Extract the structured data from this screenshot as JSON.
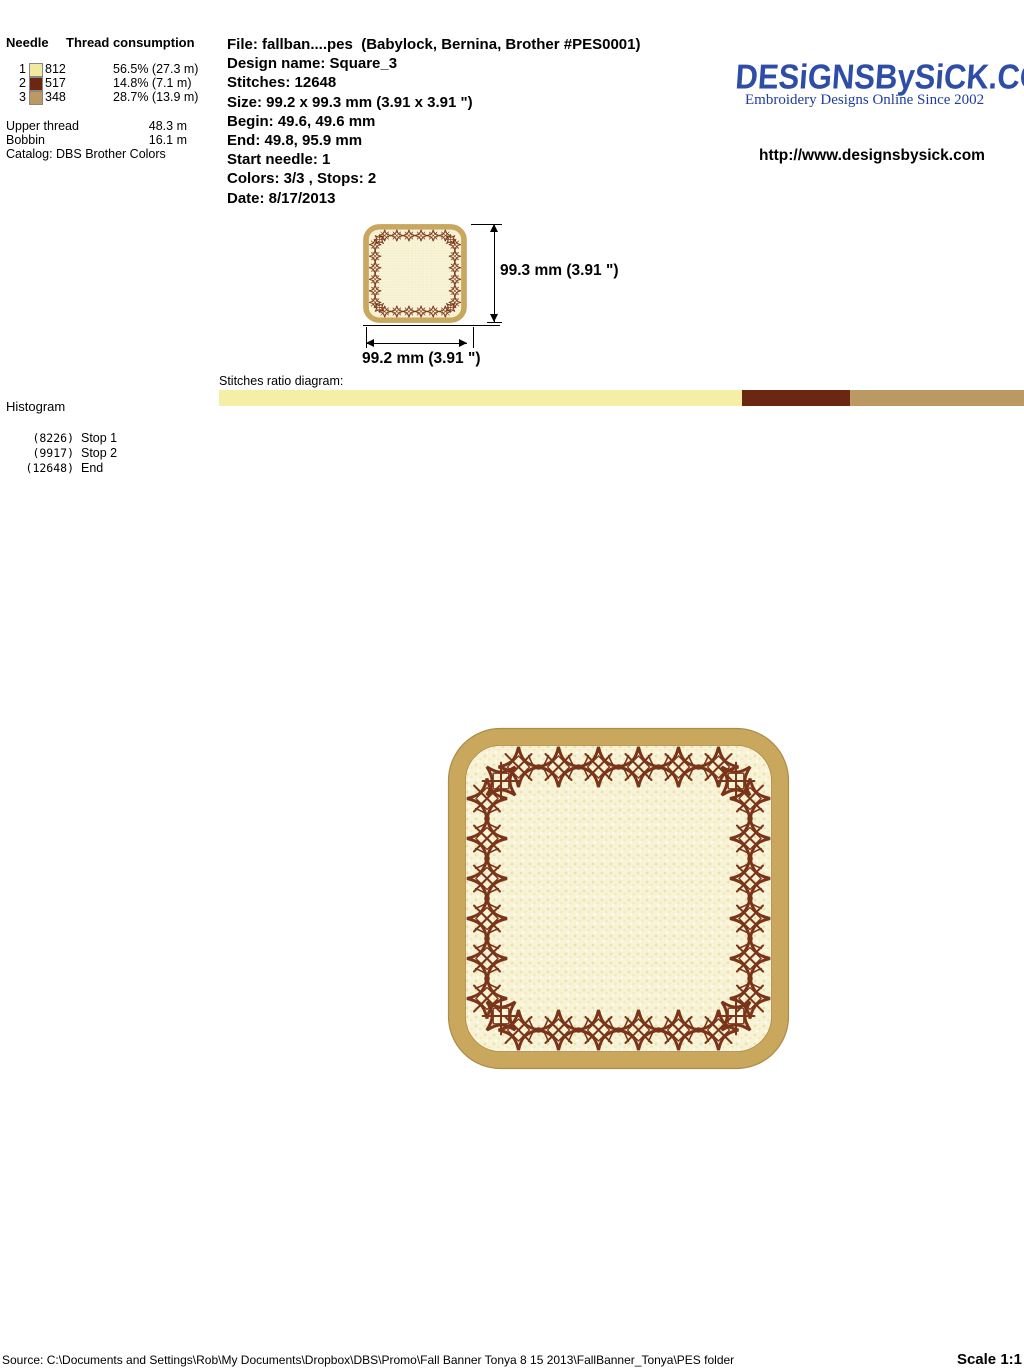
{
  "thread_table": {
    "col1_header": "Needle",
    "col2_header": "Thread consumption",
    "rows": [
      {
        "needle": "1",
        "code": "812",
        "consumption": "56.5% (27.3 m)",
        "color": "#F0E9A0"
      },
      {
        "needle": "2",
        "code": "517",
        "consumption": "14.8% (7.1 m)",
        "color": "#6B2711"
      },
      {
        "needle": "3",
        "code": "348",
        "consumption": "28.7% (13.9 m)",
        "color": "#BA9A62"
      }
    ],
    "upper_thread_label": "Upper thread",
    "upper_thread_value": "48.3 m",
    "bobbin_label": "Bobbin",
    "bobbin_value": "16.1 m",
    "catalog": "Catalog: DBS Brother Colors"
  },
  "file_info": {
    "lines": [
      "File: fallban....pes  (Babylock, Bernina, Brother #PES0001)",
      "Design name: Square_3",
      "Stitches: 12648",
      "Size: 99.2 x 99.3 mm (3.91 x 3.91 \")",
      "Begin: 49.6, 49.6 mm",
      "End: 49.8, 95.9 mm",
      "Start needle: 1",
      "Colors: 3/3 , Stops: 2",
      "Date: 8/17/2013"
    ]
  },
  "branding": {
    "logo_text": "DESiGNSBySiCK.COM",
    "tagline": "Embroidery Designs Online Since 2002",
    "url": "http://www.designsbysick.com",
    "logo_color": "#2E4DA7"
  },
  "dimensions": {
    "height_label": "99.3 mm (3.91 \")",
    "width_label": "99.2 mm (3.91 \")"
  },
  "ratio_diagram": {
    "label": "Stitches ratio diagram:",
    "segments": [
      {
        "name": "thread-1",
        "color": "#F5EFA5",
        "percent": 65.0
      },
      {
        "name": "thread-2",
        "color": "#6B2711",
        "percent": 13.4
      },
      {
        "name": "thread-3",
        "color": "#BA9A62",
        "percent": 21.6
      }
    ]
  },
  "histogram": {
    "label": "Histogram",
    "entries": [
      {
        "count": "(8226)",
        "label": "Stop 1"
      },
      {
        "count": "(9917)",
        "label": "Stop 2"
      },
      {
        "count": "(12648)",
        "label": "End"
      }
    ]
  },
  "design_colors": {
    "applique_border": "#C9A75D",
    "applique_edge": "#AD8B49",
    "fill": "#F8F3D6",
    "star": "#7A3419"
  },
  "footer": {
    "source": "Source: C:\\Documents and Settings\\Rob\\My Documents\\Dropbox\\DBS\\Promo\\Fall Banner Tonya 8 15 2013\\FallBanner_Tonya\\PES folder",
    "scale": "Scale 1:1"
  }
}
